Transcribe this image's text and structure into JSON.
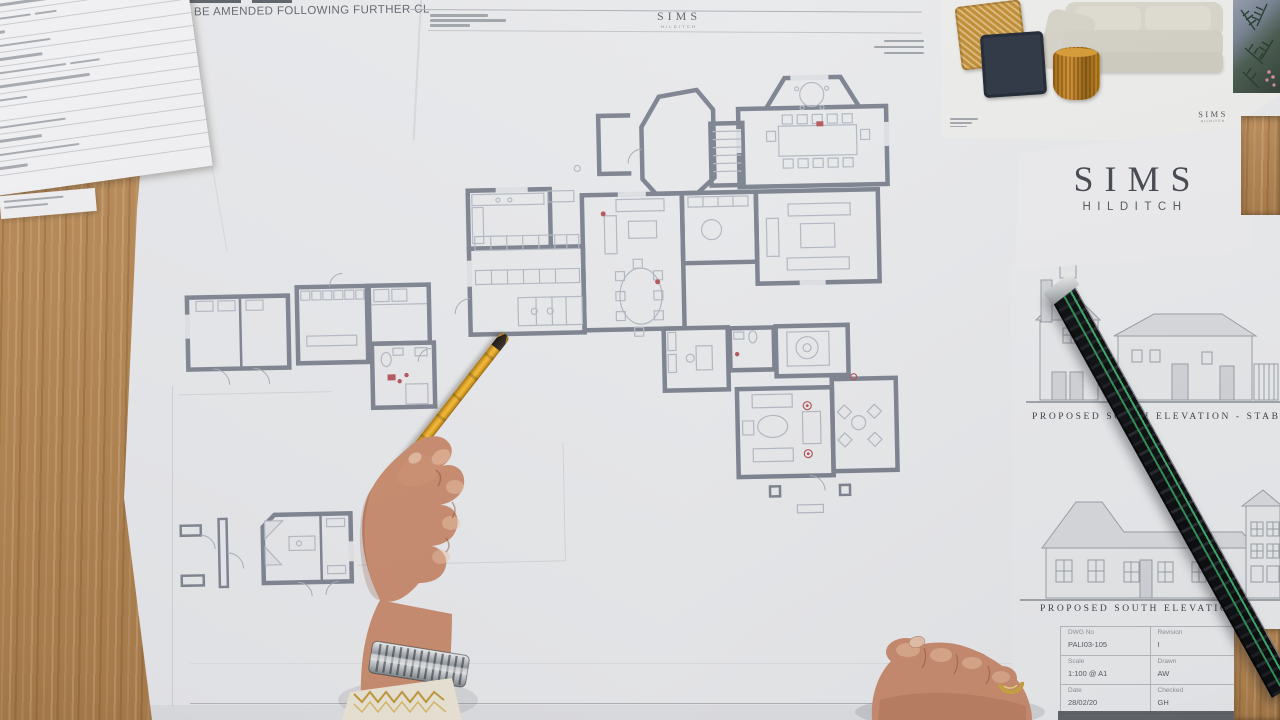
{
  "brand": {
    "name": "SIMS",
    "sub": "HILDITCH"
  },
  "note": {
    "text": "O BE AMENDED FOLLOWING FURTHER CL"
  },
  "elevations": {
    "caption_stables": "PROPOSED SOUTH ELEVATION - STAB",
    "caption_main": "PROPOSED SOUTH ELEVATION",
    "title_block": {
      "cells": [
        {
          "label": "DWG No",
          "value": "PALI03-105"
        },
        {
          "label": "Revision",
          "value": "I"
        },
        {
          "label": "Scale",
          "value": "1:100 @ A1"
        },
        {
          "label": "Drawn",
          "value": "AW"
        },
        {
          "label": "Date",
          "value": "28/02/20"
        },
        {
          "label": "Checked",
          "value": "GH"
        }
      ]
    }
  },
  "colors": {
    "wood": "#ae7f4c",
    "ruler_green": "#2e8f55",
    "pencil_yellow": "#edb02a",
    "plan_wall": "#7e8490",
    "accent_red": "#b5565c"
  }
}
